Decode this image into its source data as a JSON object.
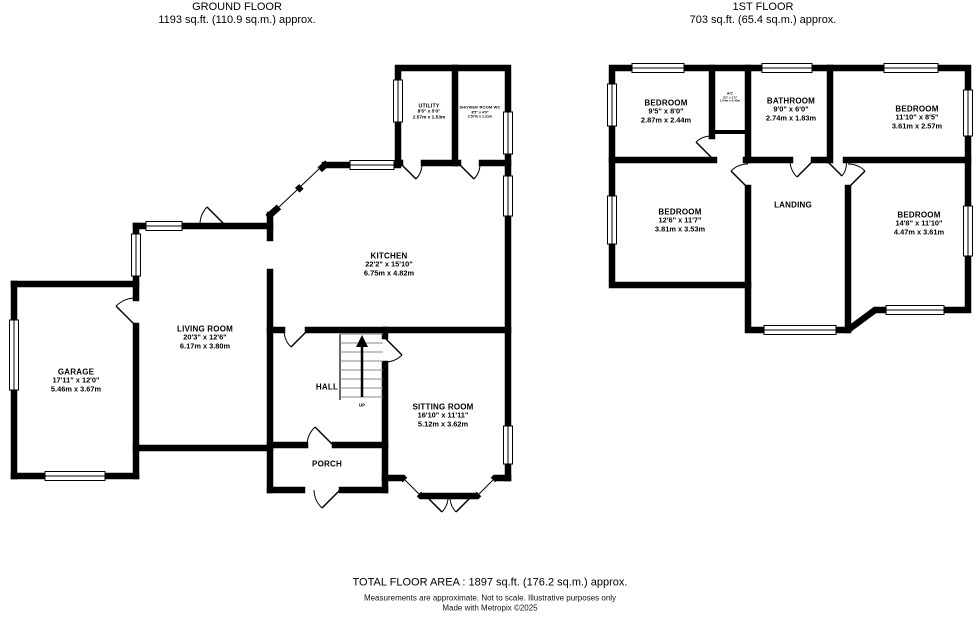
{
  "ground_floor": {
    "title": "GROUND FLOOR",
    "area": "1193 sq.ft. (110.9 sq.m.) approx.",
    "rooms": {
      "garage": {
        "name": "GARAGE",
        "imperial": "17'11\" x 12'0\"",
        "metric": "5.46m x 3.67m"
      },
      "living_room": {
        "name": "LIVING ROOM",
        "imperial": "20'3\" x 12'6\"",
        "metric": "6.17m x 3.80m"
      },
      "kitchen": {
        "name": "KITCHEN",
        "imperial": "22'2\" x 15'10\"",
        "metric": "6.75m x 4.82m"
      },
      "utility": {
        "name": "UTILITY",
        "imperial": "8'5\" x 5'0\"",
        "metric": "2.57m x 1.53m"
      },
      "shower_room": {
        "name": "SHOWER ROOM WC",
        "imperial": "8'5\" x 4'0\"",
        "metric": "2.57m x 1.21m"
      },
      "sitting_room": {
        "name": "SITTING ROOM",
        "imperial": "16'10\" x 11'11\"",
        "metric": "5.12m x 3.62m"
      },
      "hall": {
        "name": "HALL"
      },
      "porch": {
        "name": "PORCH"
      },
      "up_label": "UP"
    }
  },
  "first_floor": {
    "title": "1ST FLOOR",
    "area": "703 sq.ft. (65.4 sq.m.) approx.",
    "rooms": {
      "bedroom_1": {
        "name": "BEDROOM",
        "imperial": "9'5\" x 8'0\"",
        "metric": "2.87m x 2.44m"
      },
      "bathroom": {
        "name": "BATHROOM",
        "imperial": "9'0\" x 6'0\"",
        "metric": "2.74m x 1.83m"
      },
      "bedroom_2": {
        "name": "BEDROOM",
        "imperial": "11'10\" x 8'5\"",
        "metric": "3.61m x 2.57m"
      },
      "bedroom_3": {
        "name": "BEDROOM",
        "imperial": "12'6\" x 11'7\"",
        "metric": "3.81m x 3.53m"
      },
      "landing": {
        "name": "LANDING"
      },
      "bedroom_4": {
        "name": "BEDROOM",
        "imperial": "14'8\" x 11'10\"",
        "metric": "4.47m x 3.61m"
      },
      "airing_cupboard": {
        "name": "A/C",
        "imperial": "3'5\" x 1'5\"",
        "metric": "1.04m x 0.43m"
      }
    }
  },
  "footer": {
    "total_area": "TOTAL FLOOR AREA : 1897 sq.ft. (176.2 sq.m.) approx.",
    "disclaimer": "Measurements are approximate.  Not to scale.  Illustrative purposes only",
    "credit": "Made with Metropix ©2025"
  }
}
